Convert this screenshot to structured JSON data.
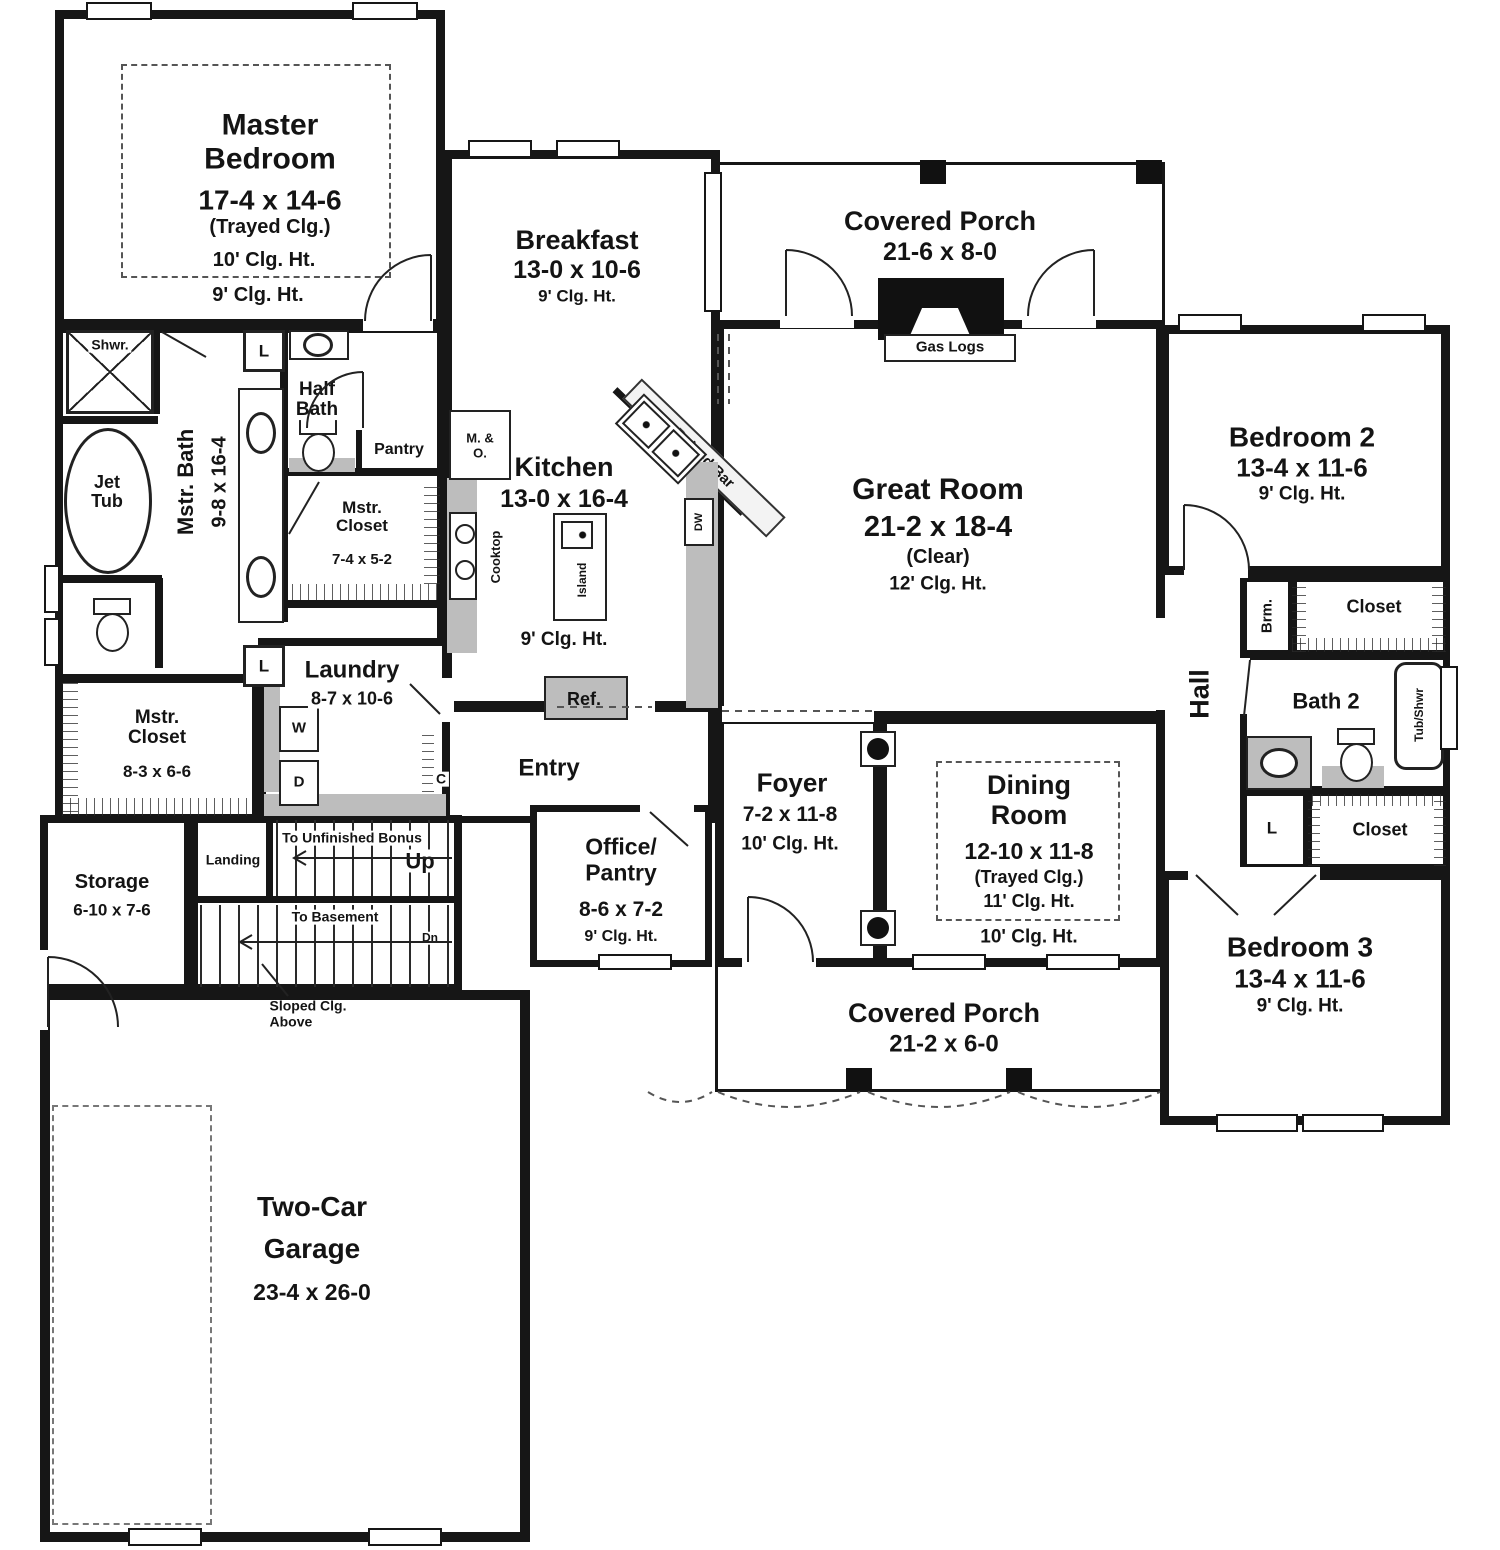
{
  "rooms": {
    "master_bedroom": {
      "name": "Master\nBedroom",
      "dims": "17-4 x 14-6",
      "tray": "(Trayed Clg.)",
      "clg_tray": "10' Clg. Ht.",
      "clg": "9' Clg. Ht."
    },
    "breakfast": {
      "name": "Breakfast",
      "dims": "13-0 x 10-6",
      "clg": "9' Clg. Ht."
    },
    "covered_porch_rear": {
      "name": "Covered Porch",
      "dims": "21-6 x 8-0"
    },
    "great_room": {
      "name": "Great Room",
      "dims": "21-2 x 18-4",
      "note": "(Clear)",
      "clg": "12' Clg. Ht."
    },
    "kitchen": {
      "name": "Kitchen",
      "dims": "13-0 x 16-4",
      "clg": "9' Clg. Ht."
    },
    "master_bath": {
      "name": "Mstr. Bath",
      "dims": "9-8 x 16-4"
    },
    "half_bath": {
      "name": "Half\nBath"
    },
    "pantry": {
      "name": "Pantry"
    },
    "master_closet_small": {
      "name": "Mstr.\nCloset",
      "dims": "7-4 x 5-2"
    },
    "master_closet_large": {
      "name": "Mstr.\nCloset",
      "dims": "8-3 x 6-6"
    },
    "laundry": {
      "name": "Laundry",
      "dims": "8-7 x 10-6"
    },
    "storage": {
      "name": "Storage",
      "dims": "6-10 x 7-6"
    },
    "entry": {
      "name": "Entry"
    },
    "office_pantry": {
      "name": "Office/\nPantry",
      "dims": "8-6 x 7-2",
      "clg": "9' Clg. Ht."
    },
    "foyer": {
      "name": "Foyer",
      "dims": "7-2 x 11-8",
      "clg": "10' Clg. Ht."
    },
    "dining_room": {
      "name": "Dining\nRoom",
      "dims": "12-10 x 11-8",
      "tray": "(Trayed Clg.)",
      "clg_tray": "11' Clg. Ht.",
      "clg": "10' Clg. Ht."
    },
    "covered_porch_front": {
      "name": "Covered Porch",
      "dims": "21-2 x 6-0"
    },
    "bedroom2": {
      "name": "Bedroom 2",
      "dims": "13-4 x 11-6",
      "clg": "9' Clg. Ht."
    },
    "bedroom3": {
      "name": "Bedroom 3",
      "dims": "13-4 x 11-6",
      "clg": "9' Clg. Ht."
    },
    "garage": {
      "name": "Two-Car\nGarage",
      "dims": "23-4 x 26-0"
    },
    "hall": {
      "name": "Hall"
    },
    "bath2": {
      "name": "Bath 2"
    }
  },
  "fixtures": {
    "gas_logs": "Gas Logs",
    "shower": "Shwr.",
    "jet_tub": "Jet\nTub",
    "linen": "L",
    "washer": "W",
    "dryer": "D",
    "coat_closet": "C",
    "broom": "Brm.",
    "closet": "Closet",
    "tub_shower": "Tub/Shwr",
    "cooktop": "Cooktop",
    "island": "Island",
    "raised_bar": "Raised Bar",
    "micro_oven": "M. &\nO.",
    "dishwasher": "DW",
    "refrigerator": "Ref."
  },
  "stairs": {
    "landing": "Landing",
    "to_bonus": "To Unfinished Bonus",
    "up": "Up",
    "to_basement": "To Basement",
    "down": "Dn",
    "sloped": "Sloped Clg.\nAbove"
  }
}
